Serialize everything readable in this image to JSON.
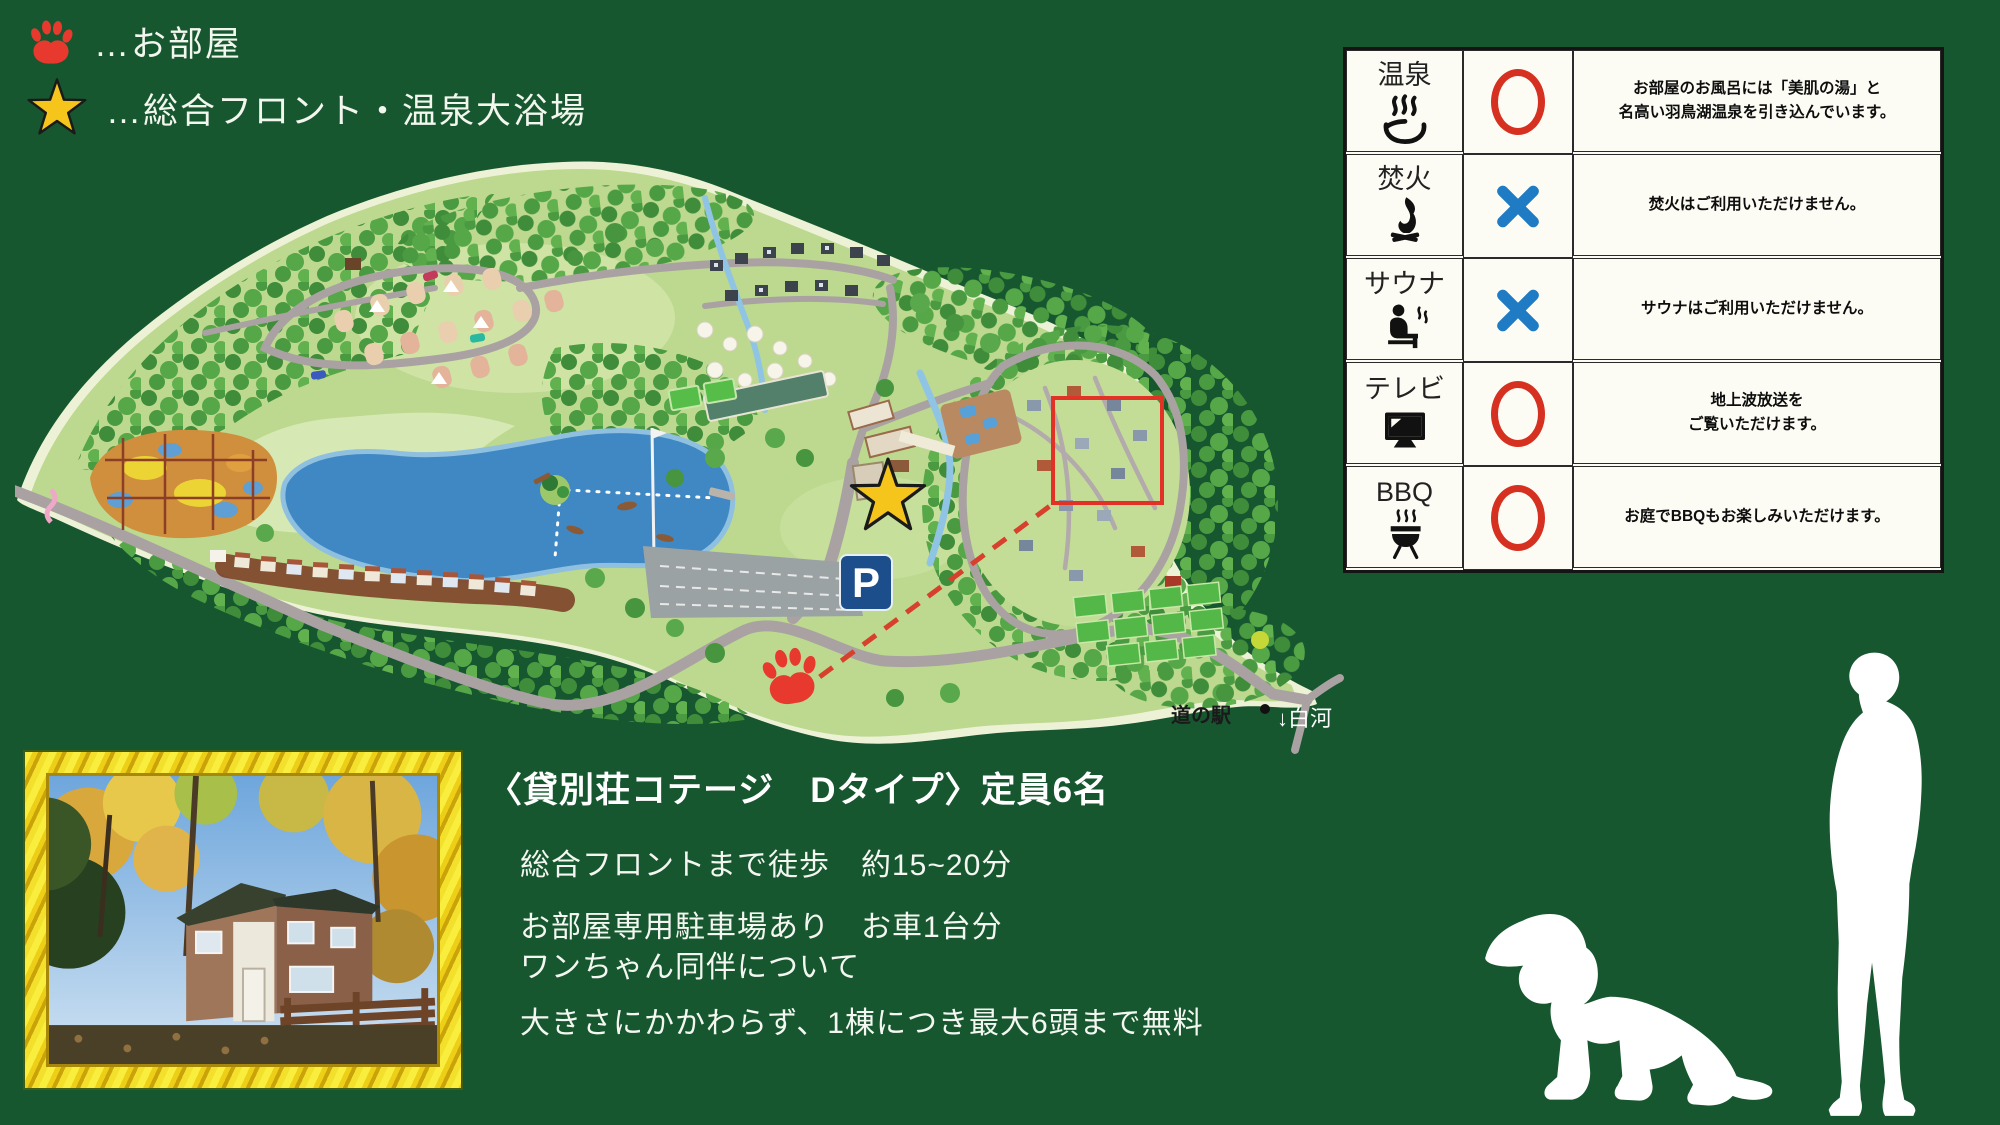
{
  "colors": {
    "background": "#17572f",
    "accent_red": "#e8392e",
    "circle_red": "#d63020",
    "cross_blue": "#1e7bc4",
    "star_gold": "#f6c51c",
    "map_cream": "#edf2d6",
    "map_land": "#bcd98f",
    "lake_blue": "#3f88c4",
    "road_gray": "#aaa2a2",
    "parking_blue": "#1d4e8c"
  },
  "legend": {
    "items": [
      {
        "icon": "paw-icon",
        "label": "…お部屋"
      },
      {
        "icon": "star-icon",
        "label": "…総合フロント・温泉大浴場"
      }
    ]
  },
  "map": {
    "parking_label": "P",
    "roadside_station_label": "道の駅",
    "direction_label": "↓白河"
  },
  "amenities_table": {
    "rows": [
      {
        "name": "温泉",
        "icon": "onsen-icon",
        "status": "yes",
        "description": "お部屋のお風呂には「美肌の湯」と\n名高い羽鳥湖温泉を引き込んでいます。"
      },
      {
        "name": "焚火",
        "icon": "bonfire-icon",
        "status": "no",
        "description": "焚火はご利用いただけません。"
      },
      {
        "name": "サウナ",
        "icon": "sauna-icon",
        "status": "no",
        "description": "サウナはご利用いただけません。"
      },
      {
        "name": "テレビ",
        "icon": "tv-icon",
        "status": "yes",
        "description": "地上波放送を\nご覧いただけます。"
      },
      {
        "name": "BBQ",
        "icon": "bbq-icon",
        "status": "yes",
        "description": "お庭でBBQもお楽しみいただけます。"
      }
    ]
  },
  "info": {
    "title": "〈貸別荘コテージ　Dタイプ〉定員6名",
    "access_lines": [
      "総合フロントまで徒歩　約15~20分",
      "お部屋専用駐車場あり　お車1台分"
    ],
    "dog_lines": [
      "ワンちゃん同伴について",
      "大きさにかかわらず、1棟につき最大6頭まで無料"
    ]
  }
}
